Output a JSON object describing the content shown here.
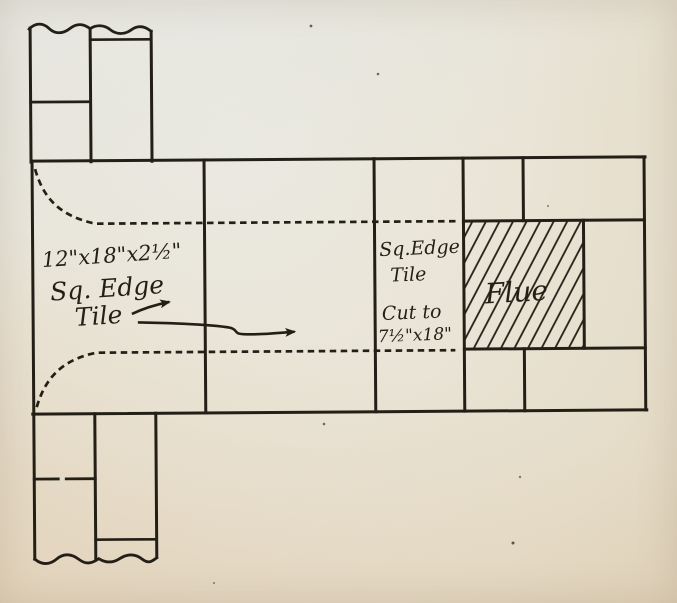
{
  "annotations": {
    "left_tile": {
      "line1": "12\"x18\"x2½\"",
      "line2": "Sq. Edge",
      "line3": "Tile"
    },
    "cut_tile": {
      "line1": "Sq.Edge",
      "line2": "Tile",
      "line3": "Cut to",
      "line4": "7½\"x18\""
    },
    "flue": "Flue"
  },
  "colors": {
    "paper": "#e9e4d6",
    "paper_warm": "#dfd2ba",
    "ink": "#241f16"
  }
}
